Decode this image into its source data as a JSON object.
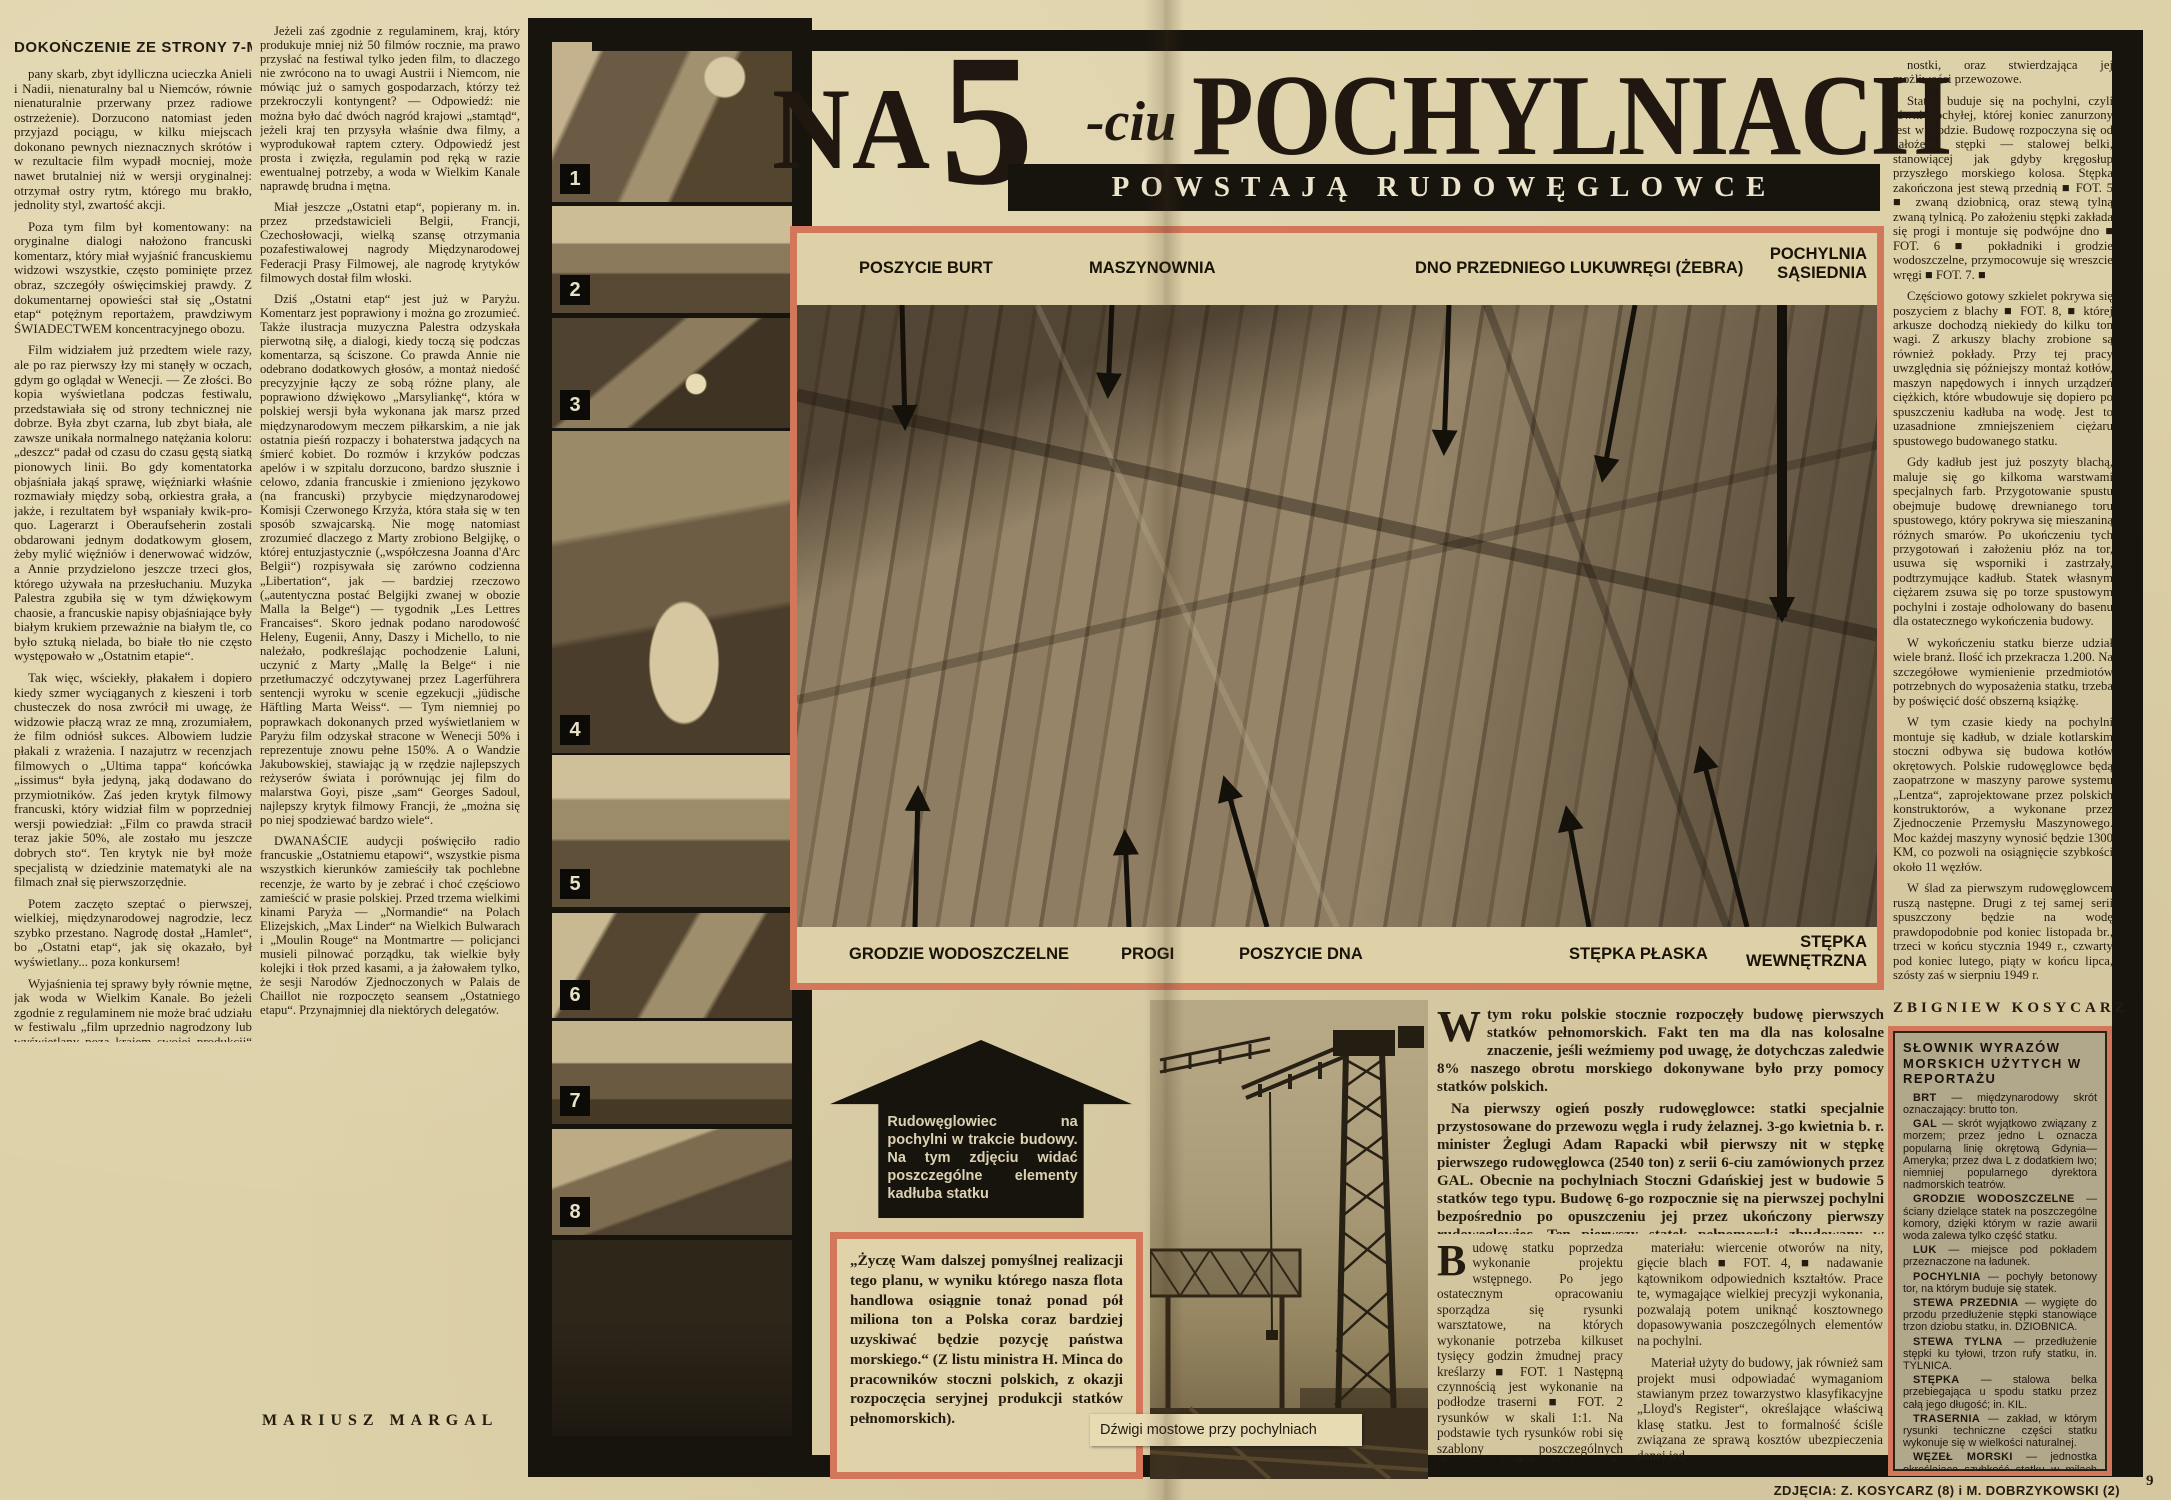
{
  "left_page": {
    "continuation_header": "DOKOŃCZENIE ZE STRONY 7-MEJ",
    "col1_paragraphs": [
      "pany skarb, zbyt idylliczna ucieczka Anieli i Nadii, nienaturalny bal u Niemców, równie nienaturalnie przerwany przez radiowe ostrzeżenie). Dorzucono natomiast jeden przyjazd pociągu, w kilku miejscach dokonano pewnych nieznacznych skrótów i w rezultacie film wypadł mocniej, może nawet brutalniej niż w wersji oryginalnej: otrzymał ostry rytm, którego mu brakło, jednolity styl, zwartość akcji.",
      "Poza tym film był komentowany: na oryginalne dialogi nałożono francuski komentarz, który miał wyjaśnić francuskiemu widzowi wszystkie, często pominięte przez obraz, szczegóły oświęcimskiej prawdy. Z dokumentarnej opowieści stał się „Ostatni etap“ potężnym reportażem, prawdziwym ŚWIADECTWEM koncentracyjnego obozu.",
      "Film widziałem już przedtem wiele razy, ale po raz pierwszy łzy mi stanęły w oczach, gdym go oglądał w Wenecji. — Ze złości. Bo kopia wyświetlana podczas festiwalu, przedstawiała się od strony technicznej nie dobrze. Była zbyt czarna, lub zbyt biała, ale zawsze unikała normalnego natężania koloru: „deszcz“ padał od czasu do czasu gęstą siatką pionowych linii. Bo gdy komentatorka objaśniała jakąś sprawę, więźniarki właśnie rozmawiały między sobą, orkiestra grała, a jakże, i rezultatem był wspaniały kwik-pro-quo. Lagerarzt i Oberaufseherin zostali obdarowani jednym dodatkowym głosem, żeby mylić więźniów i denerwować widzów, a Annie przydzielono jeszcze trzeci głos, którego używała na przesłuchaniu. Muzyka Palestra zgubiła się w tym dźwiękowym chaosie, a francuskie napisy objaśniające były białym krukiem przeważnie na białym tle, co było sztuką nielada, bo białe tło nie często występowało w „Ostatnim etapie“.",
      "Tak więc, wściekły, płakałem i dopiero kiedy szmer wyciąganych z kieszeni i torb chusteczek do nosa zwrócił mi uwagę, że widzowie płaczą wraz ze mną, zrozumiałem, że film odniósł sukces. Albowiem ludzie płakali z wrażenia. I nazajutrz w recenzjach filmowych o „Ultima tappa“ końcówka „issimus“ była jedyną, jaką dodawano do przymiotników. Zaś jeden krytyk filmowy francuski, który widział film w poprzedniej wersji powiedział: „Film co prawda stracił teraz jakie 50%, ale zostało mu jeszcze dobrych sto“. Ten krytyk nie był może specjalistą w dziedzinie matematyki ale na filmach znał się pierwszorzędnie.",
      "Potem zaczęto szeptać o pierwszej, wielkiej, międzynarodowej nagrodzie, lecz szybko przestano. Nagrodę dostał „Hamlet“, bo „Ostatni etap“, jak się okazało, był wyświetlany... poza konkursem!",
      "Wyjaśnienia tej sprawy były równie mętne, jak woda w Wielkim Kanale. Bo jeżeli zgodnie z regulaminem nie może brać udziału w festiwalu „film uprzednio nagrodzony lub wyświetlany poza krajem swojej produkcji“ — to dlaczego nie wycofano z konkursu amerykańskiej „Umowy honorowej“, która do Wenecji przybyła po nagrodzeniu jej „Oskarem 1947“, ani amerykańskiej „Wielkiej Nagrody“, która przed weneckim zanudziła już wielu widzów francuskich i angielskich, ani wreszcie szwajcarskiego filmu „Napiętnowani“, który był wyświetlany w Mariańskich Łaźniach?"
    ],
    "col2_paragraphs": [
      "Jeżeli zaś zgodnie z regulaminem, kraj, który produkuje mniej niż 50 filmów rocznie, ma prawo przysłać na festiwal tylko jeden film, to dlaczego nie zwrócono na to uwagi Austrii i Niemcom, nie mówiąc już o samych gospodarzach, którzy też przekroczyli kontyngent? — Odpowiedź: nie można było dać dwóch nagród krajowi „stamtąd“, jeżeli kraj ten przysyła właśnie dwa filmy, a wyprodukował raptem cztery. Odpowiedź jest prosta i zwięzła, regulamin pod ręką w razie ewentualnej potrzeby, a woda w Wielkim Kanale naprawdę brudna i mętna.",
      "Miał jeszcze „Ostatni etap“, popierany m. in. przez przedstawicieli Belgii, Francji, Czechosłowacji, wielką szansę otrzymania pozafestiwalowej nagrody Międzynarodowej Federacji Prasy Filmowej, ale nagrodę krytyków filmowych dostał film włoski.",
      "Dziś „Ostatni etap“ jest już w Paryżu. Komentarz jest poprawiony i można go zrozumieć. Także ilustracja muzyczna Palestra odzyskała pierwotną siłę, a dialogi, kiedy toczą się podczas komentarza, są ściszone. Co prawda Annie nie odebrano dodatkowych głosów, a montaż niedość precyzyjnie łączy ze sobą różne plany, ale poprawiono dźwiękowo „Marsyliankę“, która w polskiej wersji była wykonana jak marsz przed międzynarodowym meczem piłkarskim, a nie jak ostatnia pieśń rozpaczy i bohaterstwa jadących na śmierć kobiet. Do rozmów i krzyków podczas apelów i w szpitalu dorzucono, bardzo słusznie i celowo, zdania francuskie i zmieniono językowo (na francuski) przybycie międzynarodowej Komisji Czerwonego Krzyża, która stała się w ten sposób szwajcarską. Nie mogę natomiast zrozumieć dlaczego z Marty zrobiono Belgijkę, o której entuzjastycznie („współczesna Joanna d'Arc Belgii“) rozpisywała się zarówno codzienna „Libertation“, jak — bardziej rzeczowo („autentyczna postać Belgijki zwanej w obozie Malla la Belge“) — tygodnik „Les Lettres Francaises“. Skoro jednak podano narodowość Heleny, Eugenii, Anny, Daszy i Michello, to nie należało, podkreślając pochodzenie Laluni, uczynić z Marty „Mallę la Belge“ i nie przetłumaczyć odczytywanej przez Lagerführera sentencji wyroku w scenie egzekucji „jüdische Häftling Marta Weiss“. — Tym niemniej po poprawkach dokonanych przed wyświetlaniem w Paryżu film odzyskał stracone w Wenecji 50% i reprezentuje znowu pełne 150%. A o Wandzie Jakubowskiej, stawiając ją w rzędzie najlepszych reżyserów świata i porównując jej film do malarstwa Goyi, pisze „sam“ Georges Sadoul, najlepszy krytyk filmowy Francji, że „można się po niej spodziewać bardzo wiele“.",
      "DWANAŚCIE audycji poświęciło radio francuskie „Ostatniemu etapowi“, wszystkie pisma wszystkich kierunków zamieściły tak pochlebne recenzje, że warto by je zebrać i choć częściowo zamieścić w prasie polskiej. Przed trzema wielkimi kinami Paryża — „Normandie“ na Polach Elizejskich, „Max Linder“ na Wielkich Bulwarach i „Moulin Rouge“ na Montmartre — policjanci musieli pilnować porządku, tak wielkie były kolejki i tłok przed kasami, a ja żałowałem tylko, że sesji Narodów Zjednoczonych w Palais de Chaillot nie rozpoczęto seansem „Ostatniego etapu“. Przynajmniej dla niektórych delegatów."
    ],
    "byline": "MARIUSZ MARGAL"
  },
  "photo_strip": {
    "badges": [
      "1",
      "2",
      "3",
      "4",
      "5",
      "6",
      "7",
      "8"
    ]
  },
  "headline": {
    "word_na": "NA",
    "digit": "5",
    "suffix": "-ciu",
    "word_pochylniach": "POCHYLNIACH",
    "subtitle": "POWSTAJĄ RUDOWĘGLOWCE"
  },
  "main_photo": {
    "labels_top": [
      "POSZYCIE BURT",
      "MASZYNOWNIA",
      "DNO PRZEDNIEGO LUKU",
      "WRĘGI (ŻEBRA)",
      "POCHYLNIA SĄSIEDNIA"
    ],
    "labels_bottom": [
      "GRODZIE WODOSZCZELNE",
      "PROGI",
      "POSZYCIE DNA",
      "STĘPKA PŁASKA",
      "STĘPKA WEWNĘTRZNA"
    ]
  },
  "arrow_note": "Rudowęglowiec na pochylni w trakcie budowy. Na tym zdjęciu widać poszczególne elementy kadłuba statku",
  "quote_box": "„Życzę Wam dalszej pomyślnej realizacji tego planu, w wyniku którego nasza flota handlowa osiągnie tonaż ponad pół miliona ton a Polska coraz bardziej uzyskiwać będzie pozycję państwa morskiego.“ (Z listu ministra H. Minca do pracowników stoczni polskich, z okazji rozpoczęcia seryjnej produkcji statków pełnomorskich).",
  "crane_photo": {
    "caption": "Dźwigi mostowe przy pochylniach"
  },
  "article": {
    "intro_p1": "W tym roku polskie stocznie rozpoczęły budowę pierwszych statków pełnomorskich. Fakt ten ma dla nas kolosalne znaczenie, jeśli weźmiemy pod uwagę, że dotychczas zaledwie 8% naszego obrotu morskiego dokonywane było przy pomocy statków polskich.",
    "intro_p2": "Na pierwszy ogień poszły rudowęglowce: statki specjalnie przystosowane do przewozu węgla i rudy żelaznej. 3-go kwietnia b. r. minister Żeglugi Adam Rapacki wbił pierwszy nit w stępkę pierwszego rudowęglowca (2540 ton) z serii 6-ciu zamówionych przez GAL. Obecnie na pochylniach Stoczni Gdańskiej jest w budowie 5 statków tego typu. Budowę 6-go rozpocznie się na pierwszej pochylni bezpośrednio po opuszczeniu jej przez ukończony pierwszy rudowęglowiec. Ten pierwszy statek pełnomorski zbudowany w kraju, rękami polskiego robotnika, według projektu polskich konstruktorów, spłynie na wodę 30 b. m., w pół roku zaledwie od rozpoczęcia budowy. Od tego momentu tonaż naszej floty wynoszący w tej chwili 168.533 BRT będzie nieustannie wzrastał. Rok bieżący jest dla naszej floty handlowej rokiem przełomowym: rozpoczęliśmy następny, najważniejszy etap naszego programu morskiego.",
    "colA_p1": "Budowę statku poprzedza wykonanie projektu wstępnego. Po jego ostatecznym opracowaniu sporządza się rysunki warsztatowe, na których wykonanie potrzeba kilkuset tysięcy godzin żmudnej pracy kreślarzy ■ FOT. 1 Następną czynnością jest wykonanie na podłodze traserni ■ FOT. 2 rysunków w skali 1:1. Na podstawie tych rysunków robi się szablony poszczególnych elementów kadłuba. Służą one do wytrasowania części na materiale (blacha stalowa) ■ FOT. 3. ■ Jednocześnie w kadłubowni rozpoczyna się obróbkę",
    "colB_paragraphs": [
      "materiału: wiercenie otworów na nity, gięcie blach ■ FOT. 4, ■ nadawanie kątownikom odpowiednich kształtów. Prace te, wymagające wielkiej precyzji wykonania, pozwalają potem uniknąć kosztownego dopasowywania poszczególnych elementów na pochylni.",
      "Materiał użyty do budowy, jak również sam projekt musi odpowiadać wymaganiom stawianym przez towarzystwo klasyfikacyjne „Lloyd's Register“, określające właściwą klasę statku. Jest to formalność ściśle związana ze sprawą kosztów ubezpieczenia danej jed-"
    ],
    "rightcol_paragraphs": [
      "nostki, oraz stwierdzająca jej możliwości przewozowe.",
      "Statek buduje się na pochylni, czyli równi pochyłej, której koniec zanurzony jest w wodzie. Budowę rozpoczyna się od założenia stępki — stalowej belki, stanowiącej jak gdyby kręgosłup przyszłego morskiego kolosa. Stępka zakończona jest stewą przednią ■ FOT. 5 ■ zwaną dziobnicą, oraz stewą tylną zwaną tylnicą. Po założeniu stępki zakłada się progi i montuje się podwójne dno ■ FOT. 6 ■ pokładniki i grodzie wodoszczelne, przymocowuje się wreszcie wręgi ■ FOT. 7. ■",
      "Częściowo gotowy szkielet pokrywa się poszyciem z blachy ■ FOT. 8, ■ której arkusze dochodzą niekiedy do kilku ton wagi. Z arkuszy blachy zrobione są również pokłady. Przy tej pracy uwzględnia się późniejszy montaż kotłów, maszyn napędowych i innych urządzeń ciężkich, które wbudowuje się dopiero po spuszczeniu kadłuba na wodę. Jest to uzasadnione zmniejszeniem ciężaru spustowego budowanego statku.",
      "Gdy kadłub jest już poszyty blachą, maluje się go kilkoma warstwami specjalnych farb. Przygotowanie spustu obejmuje budowę drewnianego toru spustowego, który pokrywa się mieszaniną różnych smarów. Po ukończeniu tych przygotowań i założeniu płóz na tor, usuwa się wsporniki i zastrzały, podtrzymujące kadłub. Statek własnym ciężarem zsuwa się po torze spustowym pochylni i zostaje odholowany do basenu dla ostatecznego wykończenia budowy.",
      "W wykończeniu statku bierze udział wiele branż. Ilość ich przekracza 1.200. Na szczegółowe wymienienie przedmiotów potrzebnych do wyposażenia statku, trzeba by poświęcić dość obszerną książkę.",
      "W tym czasie kiedy na pochylni montuje się kadłub, w dziale kotlarskim stoczni odbywa się budowa kotłów okrętowych. Polskie rudowęglowce będą zaopatrzone w maszyny parowe systemu „Lentza“, zaprojektowane przez polskich konstruktorów, a wykonane przez Zjednoczenie Przemysłu Maszynowego. Moc każdej maszyny wynosić będzie 1300 KM, co pozwoli na osiągnięcie szybkości około 11 węzłów.",
      "W ślad za pierwszym rudowęglowcem ruszą następne. Drugi z tej samej serii spuszczony będzie na wodę prawdopodobnie pod koniec listopada br., trzeci w końcu stycznia 1949 r., czwarty pod koniec lutego, piąty w końcu lipca, szósty zaś w sierpniu 1949 r."
    ],
    "byline": "ZBIGNIEW KOSYCARZ"
  },
  "glossary": {
    "title": "SŁOWNIK WYRAZÓW MORSKICH UŻYTYCH W REPORTAŻU",
    "entries": [
      {
        "term": "BRT",
        "def": "międzynarodowy skrót oznaczający: brutto ton."
      },
      {
        "term": "GAL",
        "def": "skrót wyjątkowo związany z morzem; przez jedno L oznacza popularną linię okrętową Gdynia—Ameryka; przez dwa L z dodatkiem Iwo; niemniej popularnego dyrektora nadmorskich teatrów."
      },
      {
        "term": "GRODZIE WODOSZCZELNE",
        "def": "ściany dzielące statek na poszczególne komory, dzięki którym w razie awarii woda zalewa tylko część statku."
      },
      {
        "term": "LUK",
        "def": "miejsce pod pokładem przeznaczone na ładunek."
      },
      {
        "term": "POCHYLNIA",
        "def": "pochyły betonowy tor, na którym buduje się statek."
      },
      {
        "term": "STEWA PRZEDNIA",
        "def": "wygięte do przodu przedłużenie stępki stanowiące trzon dziobu statku, in. DZIOBNICA."
      },
      {
        "term": "STEWA TYLNA",
        "def": "przedłużenie stępki ku tyłowi, trzon rufy statku, in. TYLNICA."
      },
      {
        "term": "STĘPKA",
        "def": "stalowa belka przebiegająca u spodu statku przez całą jego długość; in. KIL."
      },
      {
        "term": "TRASERNIA",
        "def": "zakład, w którym rysunki techniczne części statku wykonuje się w wielkości naturalnej."
      },
      {
        "term": "WĘZEŁ MORSKI",
        "def": "jednostka określająca szybkość statku w milach na godzinę."
      },
      {
        "term": "WRĘGA",
        "def": "boczne żebro kadłuba."
      }
    ]
  },
  "footer": {
    "credits": "ZDJĘCIA: Z. KOSYCARZ (8) i M. DOBRZYKOWSKI (2)",
    "page_number": "9"
  },
  "colors": {
    "accent_frame": "#d3775a",
    "ink": "#17130d",
    "paper": "#ddd1a9"
  }
}
